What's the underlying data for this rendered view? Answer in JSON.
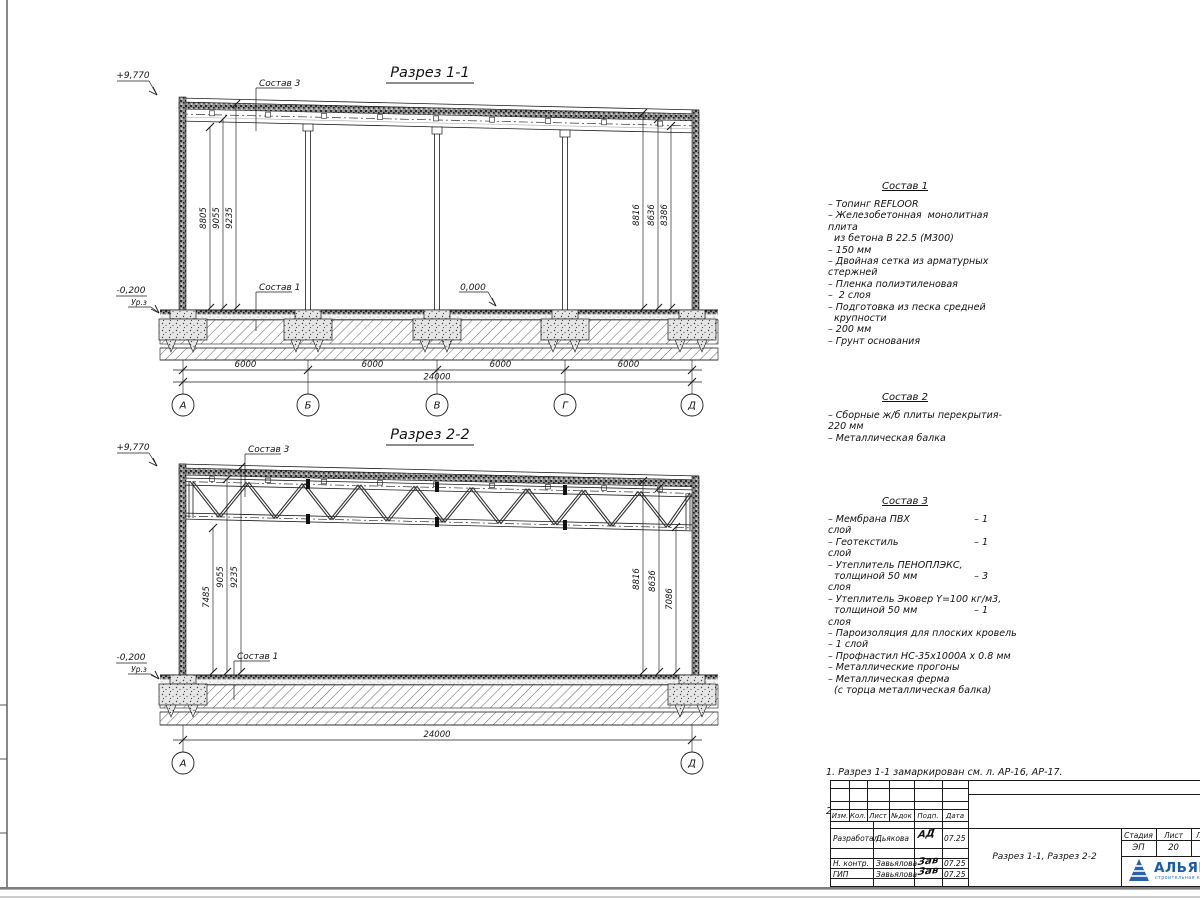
{
  "section1": {
    "title": "Разрез 1-1",
    "elev_top": "+9,770",
    "elev_zero": "0,000",
    "elev_minus": "-0,200",
    "ground_label": "Ур.з",
    "sostav3_label": "Состав 3",
    "sostav1_label": "Состав 1",
    "left_dims": [
      "8805",
      "9055",
      "9235"
    ],
    "right_dims": [
      "8816",
      "8636",
      "8386"
    ],
    "bay_dims": [
      "6000",
      "6000",
      "6000",
      "6000"
    ],
    "total_dim": "24000",
    "axes": [
      "А",
      "Б",
      "В",
      "Г",
      "Д"
    ]
  },
  "section2": {
    "title": "Разрез 2-2",
    "elev_top": "+9,770",
    "elev_minus": "-0,200",
    "ground_label": "Ур.з",
    "sostav3_label": "Состав 3",
    "sostav1_label": "Состав 1",
    "left_dims": [
      "7485",
      "9055",
      "9235"
    ],
    "right_dims": [
      "8816",
      "8636",
      "7086"
    ],
    "total_dim": "24000",
    "axes": [
      "А",
      "Д"
    ]
  },
  "sostav1": {
    "title": "Состав 1",
    "lines": [
      {
        "t": "– Топинг REFLOOR"
      },
      {
        "t": "– Железобетонная  монолитная"
      },
      {
        "t": "плита"
      },
      {
        "t": "  из бетона В 22.5 (М300)"
      },
      {
        "t": "– 150 мм"
      },
      {
        "t": "– Двойная сетка из арматурных"
      },
      {
        "t": "стержней"
      },
      {
        "t": "– Пленка полиэтиленовая"
      },
      {
        "t": "–  2 слоя"
      },
      {
        "t": "– Подготовка из песка средней"
      },
      {
        "t": "  крупности"
      },
      {
        "t": "– 200 мм"
      },
      {
        "t": "– Грунт основания"
      }
    ]
  },
  "sostav2": {
    "title": "Состав 2",
    "lines": [
      {
        "t": "– Сборные ж/б плиты перекрытия-"
      },
      {
        "t": "220 мм"
      },
      {
        "t": "– Металлическая балка"
      }
    ]
  },
  "sostav3": {
    "title": "Состав 3",
    "lines": [
      {
        "t": "– Мембрана ПВХ",
        "v": "– 1"
      },
      {
        "t": "слой"
      },
      {
        "t": "– Геотекстиль",
        "v": "– 1"
      },
      {
        "t": "слой"
      },
      {
        "t": "– Утеплитель ПЕНОПЛЭКС,"
      },
      {
        "t": "  толщиной 50 мм",
        "v": "– 3"
      },
      {
        "t": "слоя"
      },
      {
        "t": "– Утеплитель Эковер Y=100 кг/м3,"
      },
      {
        "t": "  толщиной 50 мм",
        "v": "– 1"
      },
      {
        "t": "слоя"
      },
      {
        "t": "– Пароизоляция для плоских кровель"
      },
      {
        "t": "– 1 слой"
      },
      {
        "t": "– Профнастил НС-35х1000А х 0.8 мм"
      },
      {
        "t": "– Металлические прогоны"
      },
      {
        "t": "– Металлическая ферма"
      },
      {
        "t": "  (с торца металлическая балка)"
      }
    ]
  },
  "notes": {
    "line1": "1. Разрез 1-1 замаркирован см. л. АР-16, АР-17.",
    "line2": "2. Разрез 2-2 замаркирован см. л. АР-16, АР-17."
  },
  "titleblock": {
    "col_headers": [
      "Изм.",
      "Кол.",
      "Лист",
      "№док",
      "Подп.",
      "Дата"
    ],
    "rows": [
      {
        "role": "Разработал",
        "name": "Дьякова",
        "sign": "АД",
        "date": "07.25"
      },
      {
        "role": "Н. контр.",
        "name": "Завьялова",
        "sign": "Зав",
        "date": "07.25"
      },
      {
        "role": "ГИП",
        "name": "Завьялова",
        "sign": "Зав",
        "date": "07.25"
      }
    ],
    "doc_title": "Разрез 1-1, Разрез 2-2",
    "stage_label": "Стадия",
    "stage_value": "ЭП",
    "sheet_label": "Лист",
    "sheet_value": "20",
    "sheets_label": "Листов",
    "sheets_value": "2",
    "logo_text": "АЛЬЯНС",
    "logo_tagline": "строительная компания",
    "logo_color": "#1c5ba6"
  }
}
